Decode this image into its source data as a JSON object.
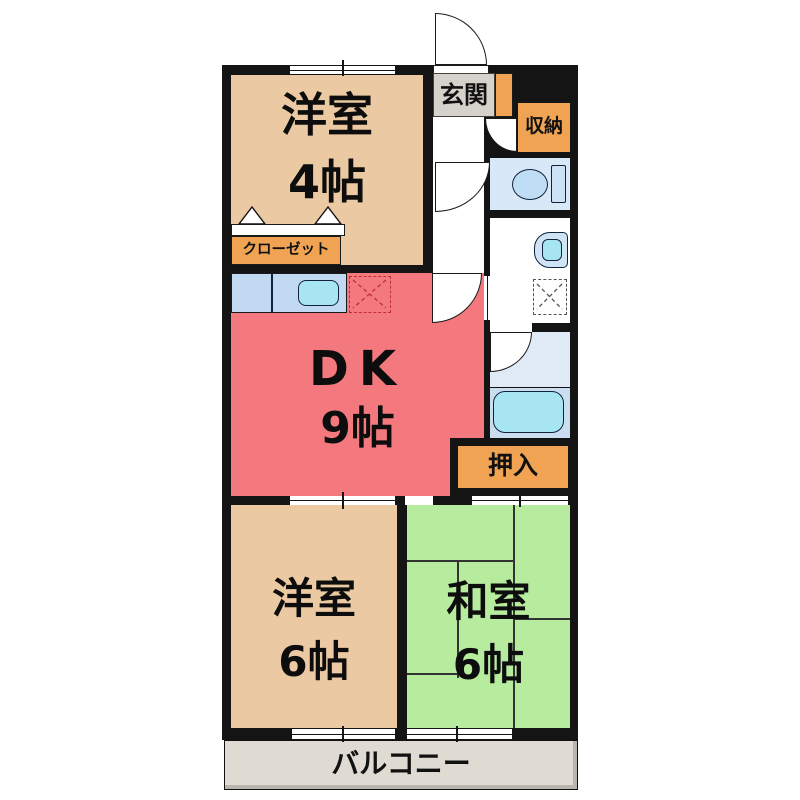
{
  "floor_plan": {
    "rooms": {
      "western4": {
        "name": "洋室",
        "size": "4帖"
      },
      "dk": {
        "name": "DK",
        "size": "9帖"
      },
      "western6": {
        "name": "洋室",
        "size": "6帖"
      },
      "japanese6": {
        "name": "和室",
        "size": "6帖"
      }
    },
    "labels": {
      "entrance": "玄関",
      "storage": "収納",
      "closet": "クローゼット",
      "oshiire": "押入",
      "balcony": "バルコニー"
    },
    "colors": {
      "wall": "#141414",
      "western_room": "#EBC9A2",
      "dk_room": "#F4797F",
      "japanese_room": "#B7EC9E",
      "label_orange": "#F0A352",
      "entrance_gray": "#D5D2CB",
      "balcony_gray": "#DFDAD2",
      "wet_room_blue": "#D9E8F7",
      "fixture_blue": "#BFDDF4",
      "tank_blue": "#CCE2F4",
      "basin_blue": "#CFE4F5",
      "counter_blue": "#C2DAF1",
      "water_cyan": "#A8E5F2",
      "bath_upper": "#E0EAF6",
      "bath_lower": "#CBDEF0",
      "tatami_line": "#333333",
      "fridge_dash": "#C03030"
    },
    "icons": {
      "toilet": "toilet-icon",
      "bathtub": "bathtub-icon",
      "washbasin": "washbasin-icon",
      "washing_machine": "washing-machine-icon",
      "kitchen_sink": "kitchen-sink-icon",
      "refrigerator_space": "refrigerator-space-icon",
      "closet_doors": "closet-folding-door-icon"
    }
  }
}
